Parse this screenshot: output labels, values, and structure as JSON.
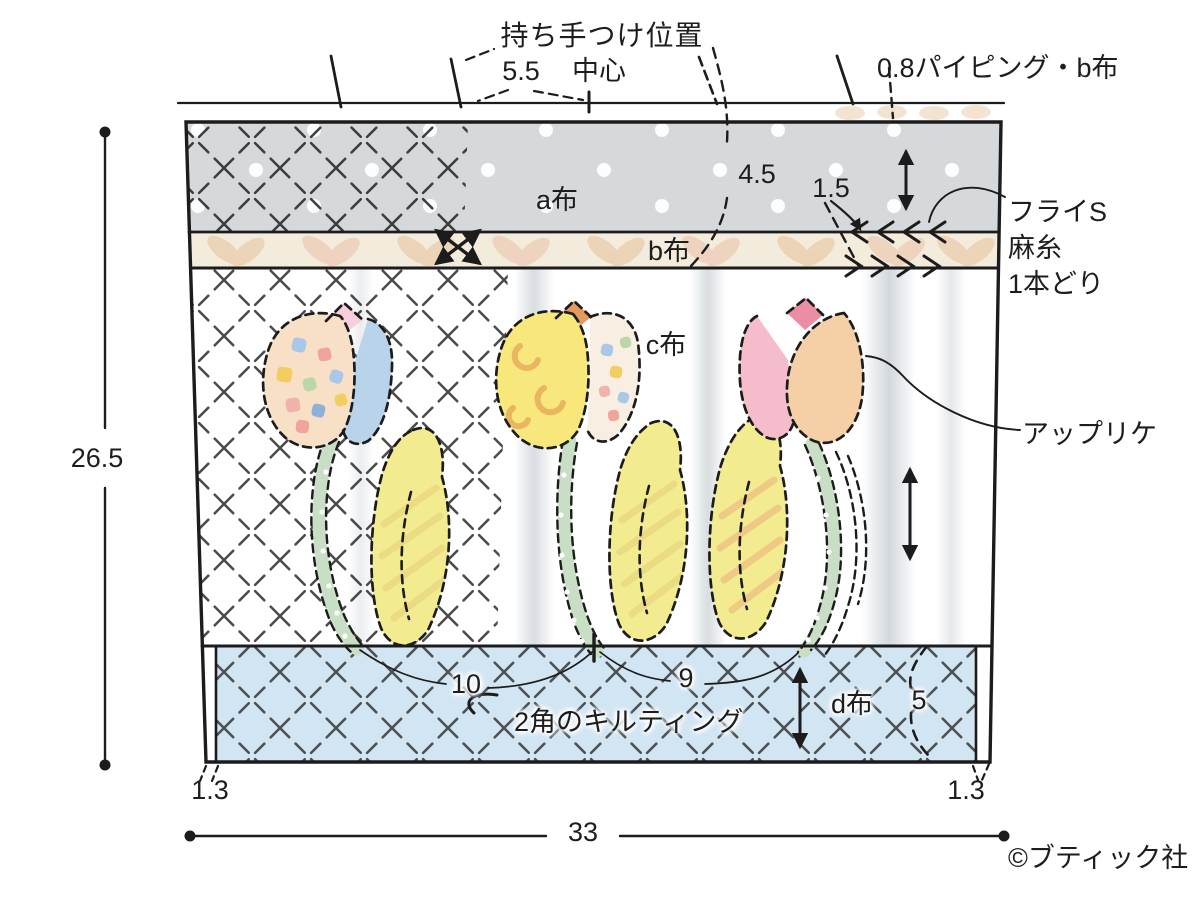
{
  "annotations": {
    "handle_position": "持ち手つけ位置",
    "handle_offset": "5.5",
    "center": "中心",
    "piping": "0.8パイピング・b布",
    "top_inset": "4.5",
    "band_height": "1.5",
    "fly_stitch": [
      "フライS",
      "麻糸",
      "1本どり"
    ],
    "applique": "アップリケ",
    "quilting": "2角のキルティング",
    "copyright": "©ブティック社"
  },
  "fabrics": {
    "a": "a布",
    "b": "b布",
    "c": "c布",
    "d": "d布"
  },
  "dimensions": {
    "height": "26.5",
    "width": "33",
    "tulip_span_left": "10",
    "tulip_span_right": "9",
    "bottom_band": "5",
    "corner_left": "1.3",
    "corner_right": "1.3"
  },
  "colors": {
    "ink": "#1c1c1c",
    "fabric_a_gray": "#d6d9dc",
    "fabric_b_cream": "#f3ecdd",
    "fabric_b_leaf": "#e9cdaa",
    "fabric_d_blue": "#d2e5f3",
    "stem_green": "#c9dfc5",
    "leaf_yellow": "#f3eb90",
    "tulip_peach": "#f7e0c6",
    "tulip_blue": "#b9d4ea",
    "tulip_pink": "#f5bccb",
    "tulip_rose": "#eb8ea3",
    "tulip_yellow": "#f8e87c",
    "tulip_orange": "#e59a5d",
    "tulip_peach2": "#f5d0a6"
  }
}
